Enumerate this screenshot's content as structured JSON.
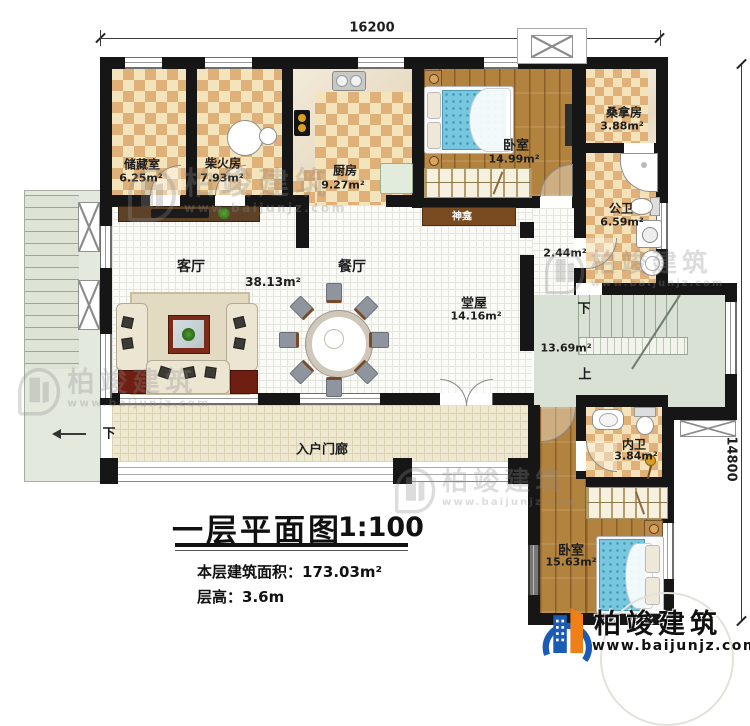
{
  "dims": {
    "top": "16200",
    "right": "14800"
  },
  "brand": {
    "name": "柏竣建筑",
    "site": "www.baijunjz.com"
  },
  "title": {
    "main": "一层平面图",
    "scale": "1:100",
    "area_label": "本层建筑面积：",
    "area_value": "173.03m²",
    "height_label": "层高：",
    "height_value": "3.6m"
  },
  "rooms": {
    "storage": {
      "name": "储藏室",
      "area": "6.25m²"
    },
    "firewood": {
      "name": "柴火房",
      "area": "7.93m²"
    },
    "kitchen": {
      "name": "厨房",
      "area": "9.27m²"
    },
    "bedroom1": {
      "name": "卧室",
      "area": "14.99m²"
    },
    "sauna": {
      "name": "桑拿房",
      "area": "3.88m²"
    },
    "pubbath": {
      "name": "公卫",
      "area": "6.59m²"
    },
    "shrine": {
      "name": "神龛"
    },
    "hallway": {
      "area": "2.44m²"
    },
    "living": {
      "name": "客厅",
      "area": "38.13m²"
    },
    "dining": {
      "name": "餐厅"
    },
    "hall": {
      "name": "堂屋",
      "area": "14.16m²"
    },
    "stairs": {
      "area": "13.69m²",
      "down": "下",
      "up": "上"
    },
    "innerbath": {
      "name": "内卫",
      "area": "3.84m²"
    },
    "bedroom2": {
      "name": "卧室",
      "area": "15.63m²"
    },
    "porch": {
      "name": "入户门廊",
      "down": "下"
    }
  }
}
